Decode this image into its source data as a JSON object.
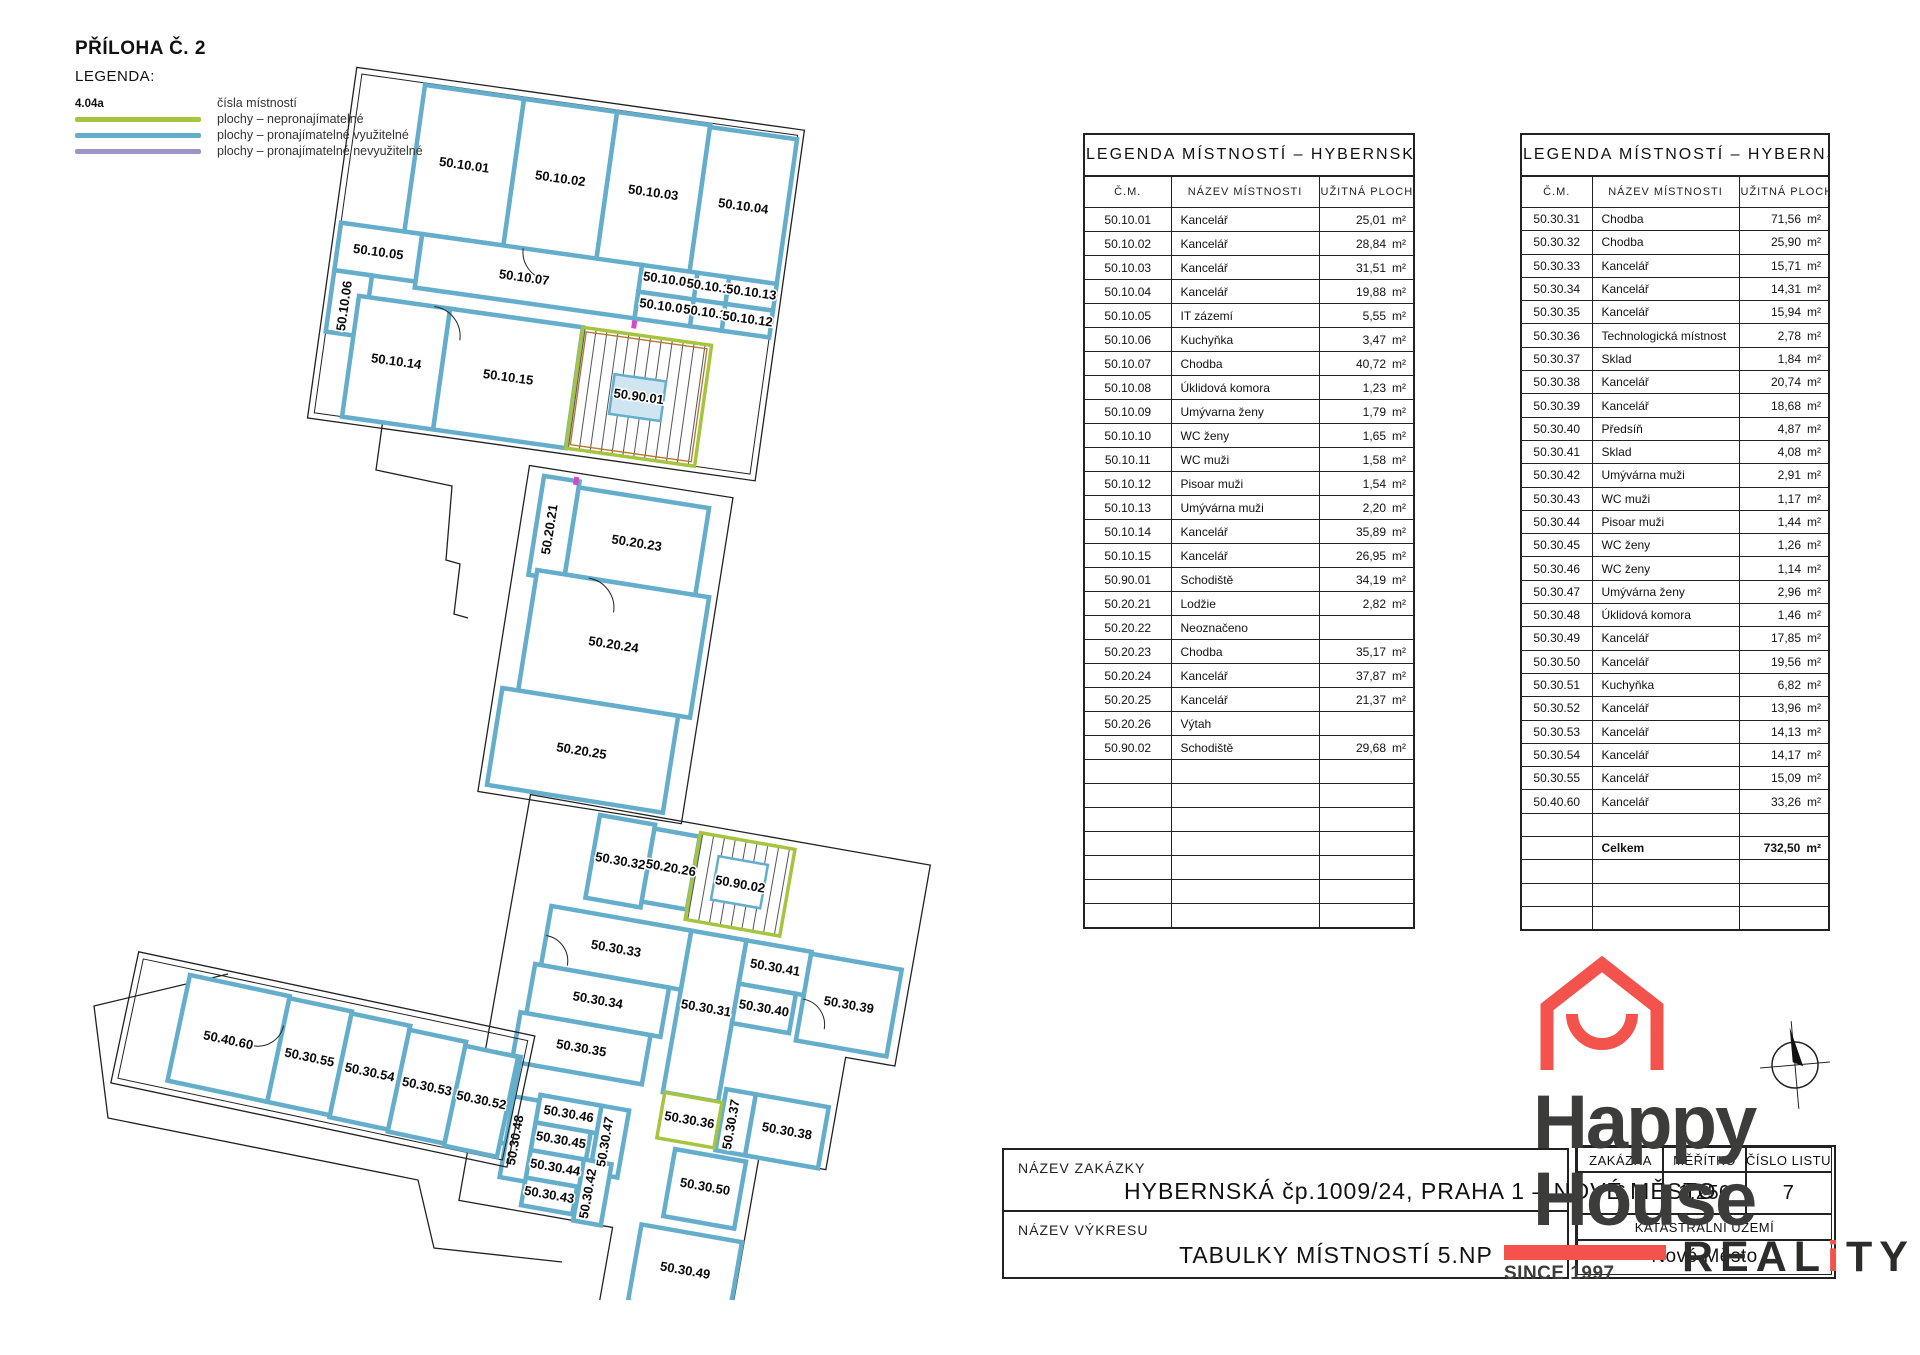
{
  "legend": {
    "priloha": "PŘÍLOHA Č. 2",
    "title": "LEGENDA:",
    "items": [
      {
        "sample": "4.04a",
        "color": "",
        "label": "čísla místností"
      },
      {
        "sample": "",
        "color": "#A6C43F",
        "label": "plochy – nepronajímatelné"
      },
      {
        "sample": "",
        "color": "#64AECB",
        "label": "plochy – pronajímatelné využitelné"
      },
      {
        "sample": "",
        "color": "#9E93C8",
        "label": "plochy – pronajímatelné nevyužitelné"
      }
    ]
  },
  "tables": [
    {
      "title": "LEGENDA MÍSTNOSTÍ – HYBERNSKÁ",
      "columns": [
        "Č.M.",
        "NÁZEV MÍSTNOSTI",
        "UŽITNÁ PLOCHA"
      ],
      "rows": [
        [
          "50.10.01",
          "Kancelář",
          "25,01"
        ],
        [
          "50.10.02",
          "Kancelář",
          "28,84"
        ],
        [
          "50.10.03",
          "Kancelář",
          "31,51"
        ],
        [
          "50.10.04",
          "Kancelář",
          "19,88"
        ],
        [
          "50.10.05",
          "IT zázemí",
          "5,55"
        ],
        [
          "50.10.06",
          "Kuchyňka",
          "3,47"
        ],
        [
          "50.10.07",
          "Chodba",
          "40,72"
        ],
        [
          "50.10.08",
          "Úklidová komora",
          "1,23"
        ],
        [
          "50.10.09",
          "Umývarna ženy",
          "1,79"
        ],
        [
          "50.10.10",
          "WC ženy",
          "1,65"
        ],
        [
          "50.10.11",
          "WC muži",
          "1,58"
        ],
        [
          "50.10.12",
          "Pisoar muži",
          "1,54"
        ],
        [
          "50.10.13",
          "Umývárna muži",
          "2,20"
        ],
        [
          "50.10.14",
          "Kancelář",
          "35,89"
        ],
        [
          "50.10.15",
          "Kancelář",
          "26,95"
        ],
        [
          "50.90.01",
          "Schodiště",
          "34,19"
        ],
        [
          "50.20.21",
          "Lodžie",
          "2,82"
        ],
        [
          "50.20.22",
          "Neoznačeno",
          ""
        ],
        [
          "50.20.23",
          "Chodba",
          "35,17"
        ],
        [
          "50.20.24",
          "Kancelář",
          "37,87"
        ],
        [
          "50.20.25",
          "Kancelář",
          "21,37"
        ],
        [
          "50.20.26",
          "Výtah",
          ""
        ],
        [
          "50.90.02",
          "Schodiště",
          "29,68"
        ],
        [
          "",
          "",
          ""
        ],
        [
          "",
          "",
          ""
        ],
        [
          "",
          "",
          ""
        ],
        [
          "",
          "",
          ""
        ],
        [
          "",
          "",
          ""
        ],
        [
          "",
          "",
          ""
        ],
        [
          "",
          "",
          ""
        ]
      ]
    },
    {
      "title": "LEGENDA MÍSTNOSTÍ – HYBERNSKÁ",
      "columns": [
        "Č.M.",
        "NÁZEV MÍSTNOSTI",
        "UŽITNÁ PLOCHA"
      ],
      "rows": [
        [
          "50.30.31",
          "Chodba",
          "71,56"
        ],
        [
          "50.30.32",
          "Chodba",
          "25,90"
        ],
        [
          "50.30.33",
          "Kancelář",
          "15,71"
        ],
        [
          "50.30.34",
          "Kancelář",
          "14,31"
        ],
        [
          "50.30.35",
          "Kancelář",
          "15,94"
        ],
        [
          "50.30.36",
          "Technologická místnost",
          "2,78"
        ],
        [
          "50.30.37",
          "Sklad",
          "1,84"
        ],
        [
          "50.30.38",
          "Kancelář",
          "20,74"
        ],
        [
          "50.30.39",
          "Kancelář",
          "18,68"
        ],
        [
          "50.30.40",
          "Předsíň",
          "4,87"
        ],
        [
          "50.30.41",
          "Sklad",
          "4,08"
        ],
        [
          "50.30.42",
          "Umývárna muži",
          "2,91"
        ],
        [
          "50.30.43",
          "WC muži",
          "1,17"
        ],
        [
          "50.30.44",
          "Pisoar muži",
          "1,44"
        ],
        [
          "50.30.45",
          "WC ženy",
          "1,26"
        ],
        [
          "50.30.46",
          "WC ženy",
          "1,14"
        ],
        [
          "50.30.47",
          "Umývárna ženy",
          "2,96"
        ],
        [
          "50.30.48",
          "Úklidová komora",
          "1,46"
        ],
        [
          "50.30.49",
          "Kancelář",
          "17,85"
        ],
        [
          "50.30.50",
          "Kancelář",
          "19,56"
        ],
        [
          "50.30.51",
          "Kuchyňka",
          "6,82"
        ],
        [
          "50.30.52",
          "Kancelář",
          "13,96"
        ],
        [
          "50.30.53",
          "Kancelář",
          "14,13"
        ],
        [
          "50.30.54",
          "Kancelář",
          "14,17"
        ],
        [
          "50.30.55",
          "Kancelář",
          "15,09"
        ],
        [
          "50.40.60",
          "Kancelář",
          "33,26"
        ],
        [
          "",
          "",
          ""
        ],
        [
          "",
          "Celkem",
          "732,50",
          "total"
        ],
        [
          "",
          "",
          ""
        ],
        [
          "",
          "",
          ""
        ],
        [
          "",
          "",
          ""
        ]
      ]
    }
  ],
  "plan": {
    "labels": [
      {
        "g": "ga",
        "t": "50.10.01",
        "x": 50,
        "y": 78
      },
      {
        "g": "ga",
        "t": "50.10.02",
        "x": 147,
        "y": 78
      },
      {
        "g": "ga",
        "t": "50.10.03",
        "x": 241,
        "y": 79
      },
      {
        "g": "ga",
        "t": "50.10.04",
        "x": 332,
        "y": 80
      },
      {
        "g": "ga",
        "t": "50.10.05",
        "x": -23,
        "y": 176
      },
      {
        "g": "ga",
        "t": "50.10.06",
        "x": -45,
        "y": 230,
        "r": -90
      },
      {
        "g": "ga",
        "t": "50.10.07",
        "x": 125,
        "y": 181
      },
      {
        "g": "ga",
        "t": "50.10.09",
        "x": 268,
        "y": 163
      },
      {
        "g": "ga",
        "t": "50.10.10",
        "x": 312,
        "y": 164
      },
      {
        "g": "ga",
        "t": "50.10.13",
        "x": 352,
        "y": 164
      },
      {
        "g": "ga",
        "t": "50.10.08",
        "x": 268,
        "y": 190
      },
      {
        "g": "ga",
        "t": "50.10.11",
        "x": 312,
        "y": 190
      },
      {
        "g": "ga",
        "t": "50.10.12",
        "x": 352,
        "y": 191
      },
      {
        "g": "ga",
        "t": "50.10.14",
        "x": 10,
        "y": 282
      },
      {
        "g": "ga",
        "t": "50.10.15",
        "x": 123,
        "y": 282
      },
      {
        "g": "ga",
        "t": "50.90.01",
        "x": 255,
        "y": 283
      },
      {
        "g": "gb",
        "t": "50.20.21",
        "x": 18,
        "y": 58,
        "r": -90
      },
      {
        "g": "gb",
        "t": "50.20.23",
        "x": 102,
        "y": 62
      },
      {
        "g": "gb",
        "t": "50.20.24",
        "x": 95,
        "y": 166
      },
      {
        "g": "gb",
        "t": "50.20.25",
        "x": 80,
        "y": 276
      },
      {
        "g": "gc",
        "t": "50.30.32",
        "x": 28,
        "y": 46
      },
      {
        "g": "gc",
        "t": "50.20.26",
        "x": 79,
        "y": 44
      },
      {
        "g": "gc",
        "t": "50.90.02",
        "x": 150,
        "y": 48
      },
      {
        "g": "gc",
        "t": "50.30.33",
        "x": 39,
        "y": 133
      },
      {
        "g": "gc",
        "t": "50.30.34",
        "x": 30,
        "y": 187
      },
      {
        "g": "gc",
        "t": "50.30.35",
        "x": 22,
        "y": 237
      },
      {
        "g": "gc",
        "t": "50.30.31",
        "x": 138,
        "y": 176
      },
      {
        "g": "gc",
        "t": "50.30.41",
        "x": 199,
        "y": 124
      },
      {
        "g": "gc",
        "t": "50.30.40",
        "x": 195,
        "y": 166
      },
      {
        "g": "gc",
        "t": "50.30.39",
        "x": 278,
        "y": 148
      },
      {
        "g": "gc",
        "t": "50.30.36",
        "x": 141,
        "y": 289
      },
      {
        "g": "gc",
        "t": "50.30.37",
        "x": 187,
        "y": 282,
        "r": -90
      },
      {
        "g": "gc",
        "t": "50.30.38",
        "x": 239,
        "y": 283
      },
      {
        "g": "gc",
        "t": "50.30.51",
        "x": -50,
        "y": 298,
        "r": -90
      },
      {
        "g": "gc",
        "t": "50.30.48",
        "x": -23,
        "y": 335,
        "r": -90
      },
      {
        "g": "gc",
        "t": "50.30.46",
        "x": 21,
        "y": 304
      },
      {
        "g": "gc",
        "t": "50.30.45",
        "x": 18,
        "y": 331
      },
      {
        "g": "gc",
        "t": "50.30.44",
        "x": 17,
        "y": 359
      },
      {
        "g": "gc",
        "t": "50.30.43",
        "x": 16,
        "y": 387
      },
      {
        "g": "gc",
        "t": "50.30.47",
        "x": 66,
        "y": 321,
        "r": -90
      },
      {
        "g": "gc",
        "t": "50.30.42",
        "x": 58,
        "y": 375,
        "r": -90
      },
      {
        "g": "gc",
        "t": "50.30.50",
        "x": 168,
        "y": 352
      },
      {
        "g": "gc",
        "t": "50.30.49",
        "x": 163,
        "y": 438
      },
      {
        "g": "gd",
        "t": "50.40.60",
        "x": 51,
        "y": 60
      },
      {
        "g": "gd",
        "t": "50.30.55",
        "x": 134,
        "y": 60
      },
      {
        "g": "gd",
        "t": "50.30.54",
        "x": 196,
        "y": 62
      },
      {
        "g": "gd",
        "t": "50.30.53",
        "x": 255,
        "y": 64
      },
      {
        "g": "gd",
        "t": "50.30.52",
        "x": 311,
        "y": 66
      }
    ]
  },
  "title_block": {
    "nazev_zakazky_label": "NÁZEV ZAKÁZKY",
    "nazev_zakazky": "HYBERNSKÁ čp.1009/24, PRAHA 1 – NOVÉ MĚSTO",
    "nazev_vykresu_label": "NÁZEV VÝKRESU",
    "nazev_vykresu": "TABULKY MÍSTNOSTÍ 5.NP",
    "info": {
      "zakazka_label": "ZAKÁZKA",
      "meritko_label": "MĚŘÍTKO",
      "cislo_listu_label": "ČÍSLO LISTU",
      "zakazka": "6",
      "meritko": "1:250",
      "cislo_listu": "7",
      "katastr_label": "KATASTRÁLNÍ ÚZEMÍ",
      "katastr": "Nové Město"
    }
  },
  "logo": {
    "word1": "Happy",
    "word2": "House",
    "word3_real": "REAL",
    "word3_i": "i",
    "word3_ty": "TY",
    "since": "SINCE 1997",
    "red": "#F4524D",
    "dark": "#3C3C3B"
  }
}
